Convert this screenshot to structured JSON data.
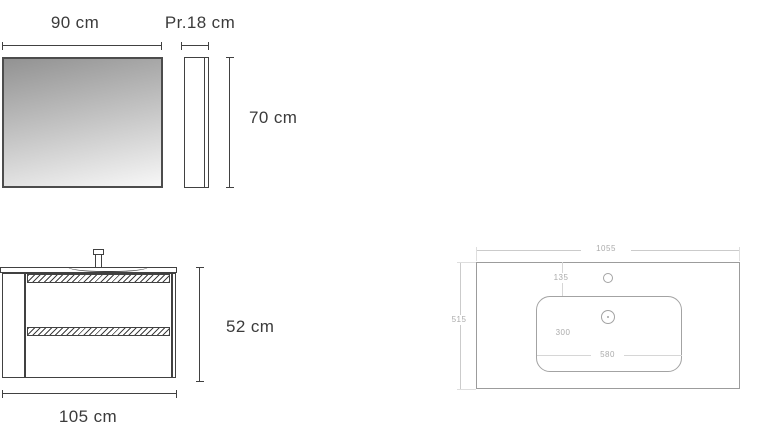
{
  "diagram": {
    "mirror": {
      "width_label": "90 cm",
      "depth_label": "Pr.18 cm",
      "height_label": "70 cm"
    },
    "vanity": {
      "height_label": "52 cm",
      "width_label": "105 cm"
    },
    "sink_top_view": {
      "width_label": "1055",
      "depth_label": "515",
      "faucet_offset_label": "135",
      "basin_depth_label": "300",
      "basin_width_label": "580"
    },
    "colors": {
      "dark_line": "#414141",
      "dark_text": "#3b3b3b",
      "light_line": "#9c9c9c",
      "light_dim_line": "#cbcbcb",
      "light_text": "#ababab",
      "mirror_gradient_top": "#929292",
      "mirror_gradient_bottom": "#f7f7f7",
      "background": "#ffffff"
    }
  }
}
